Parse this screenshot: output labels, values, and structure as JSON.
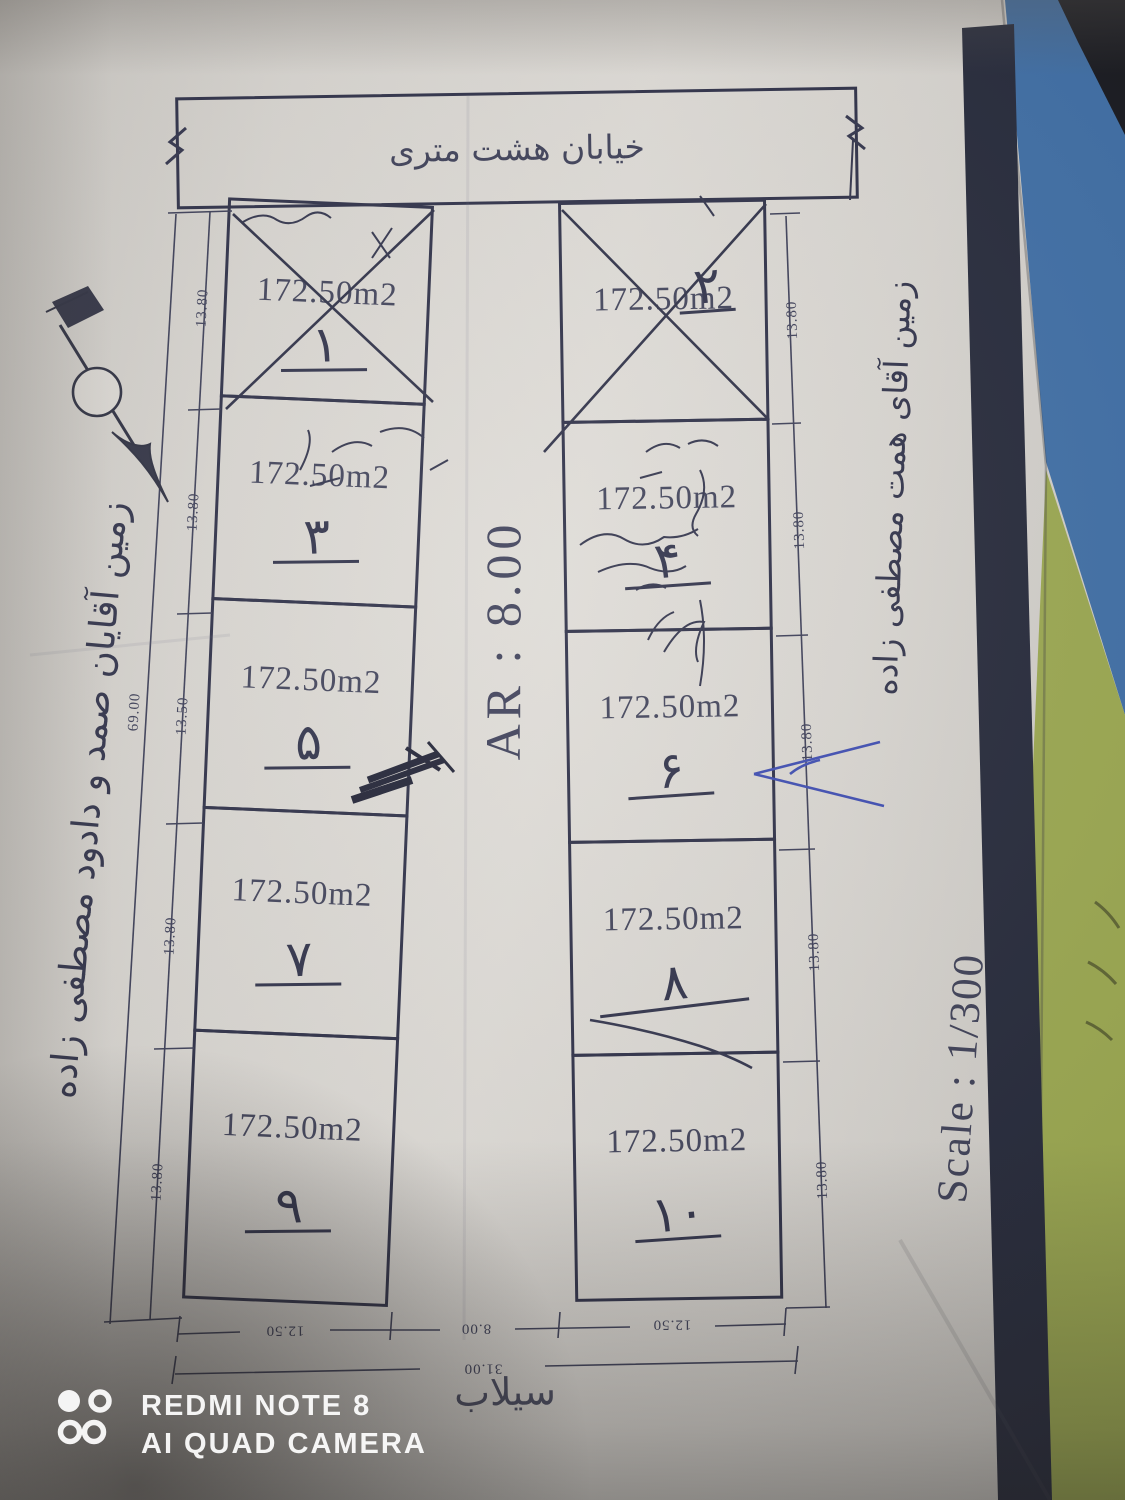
{
  "plan": {
    "street_label": "خیابان هشت متری",
    "canal_label": "سیلاب",
    "ar_label": "AR : 8.00",
    "scale_label": "Scale : 1/300",
    "owner_left": "زمین آقایان صمد و دادود مصطفی زاده",
    "owner_right": "زمین آقای همت مصطفی زاده",
    "north_label": "N",
    "left_total_dim": "69.00",
    "bottom": {
      "left_width": "12.50",
      "street_width": "8.00",
      "right_width": "12.50",
      "total": "31.00"
    },
    "left_plots": [
      {
        "number": "۱",
        "area": "172.50m2",
        "side_dim": "13.80",
        "crossed": true
      },
      {
        "number": "۳",
        "area": "172.50m2",
        "side_dim": "13.80",
        "crossed": false
      },
      {
        "number": "۵",
        "area": "172.50m2",
        "side_dim": "13.50",
        "crossed": false
      },
      {
        "number": "۷",
        "area": "172.50m2",
        "side_dim": "13.80",
        "crossed": false
      },
      {
        "number": "۹",
        "area": "172.50m2",
        "side_dim": "13.80",
        "crossed": false
      }
    ],
    "right_plots": [
      {
        "number": "۲",
        "area": "172.50m2",
        "side_dim": "13.80",
        "crossed": true
      },
      {
        "number": "۴",
        "area": "172.50m2",
        "side_dim": "13.80",
        "crossed": false
      },
      {
        "number": "۶",
        "area": "172.50m2",
        "side_dim": "13.80",
        "crossed": false
      },
      {
        "number": "۸",
        "area": "172.50m2",
        "side_dim": "13.80",
        "crossed": false
      },
      {
        "number": "۱۰",
        "area": "172.50m2",
        "side_dim": "13.80",
        "crossed": false
      }
    ],
    "colors": {
      "ink": "#2b2d45",
      "paper": "#d8d5d0",
      "stripe": "#232738",
      "table_blue": "#3d6da5",
      "table_green": "#9aa74e"
    }
  },
  "photo": {
    "watermark": {
      "line1": "REDMI NOTE 8",
      "line2": "AI QUAD CAMERA"
    }
  }
}
